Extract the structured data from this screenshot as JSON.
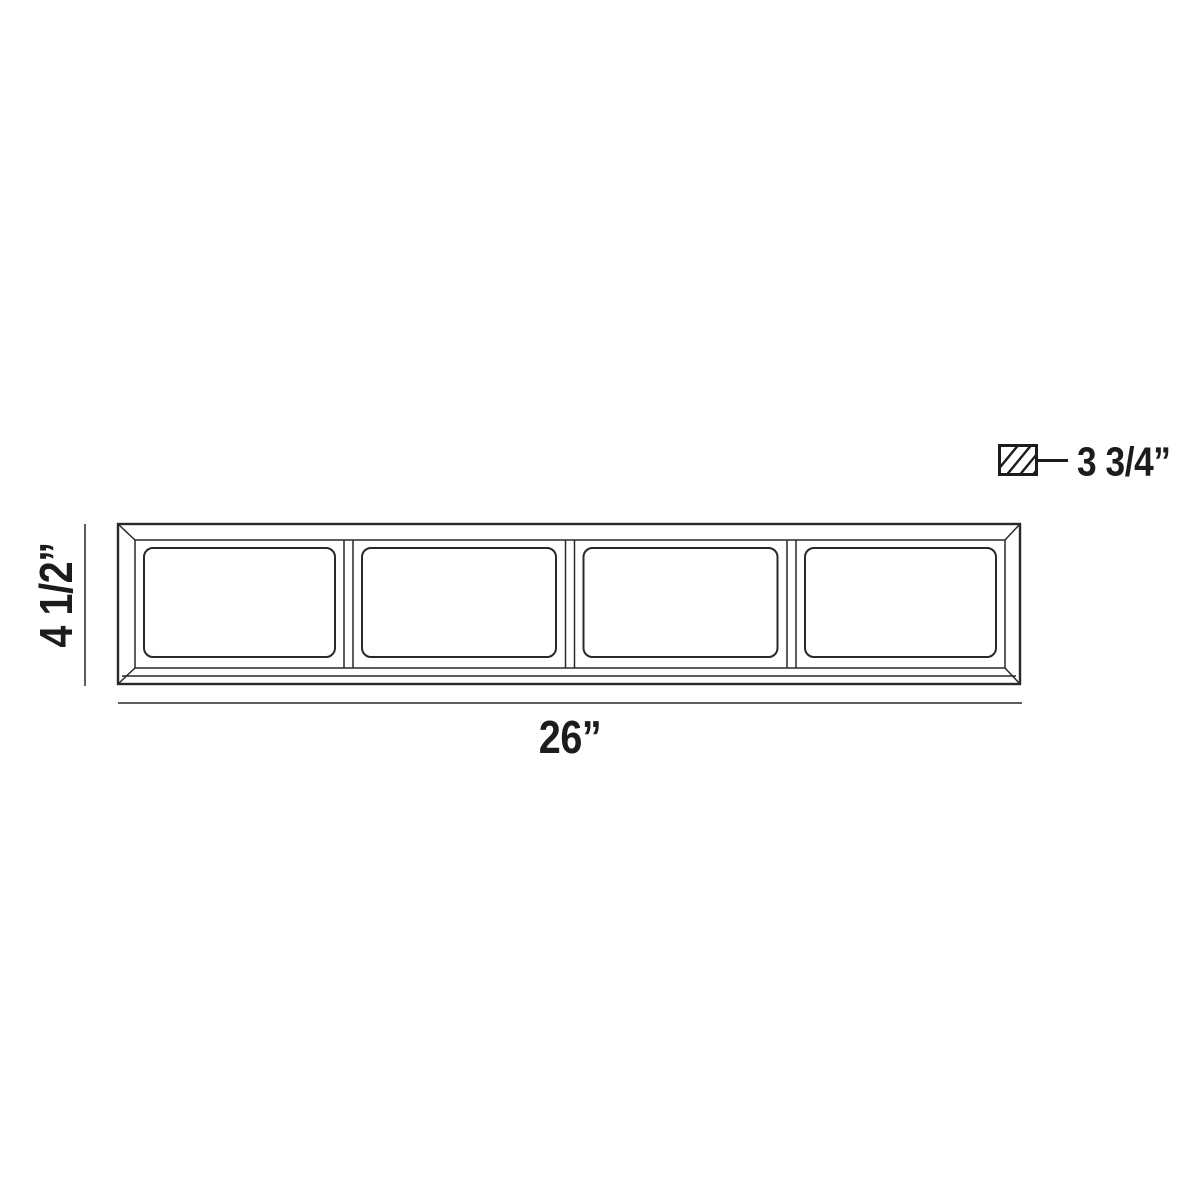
{
  "diagram": {
    "kind": "product dimension line drawing",
    "fixture": {
      "panel_count": 4
    },
    "dimensions": {
      "width": "26”",
      "height": "4 1/2”",
      "depth": "3 3/4”"
    },
    "colors": {
      "background": "#ffffff",
      "drawing_line": "#27292b",
      "dimension_line": "#5a5f63",
      "label_text": "#1c1c1c"
    },
    "icons": {
      "depth_symbol": "hatched-rectangle-icon"
    }
  }
}
